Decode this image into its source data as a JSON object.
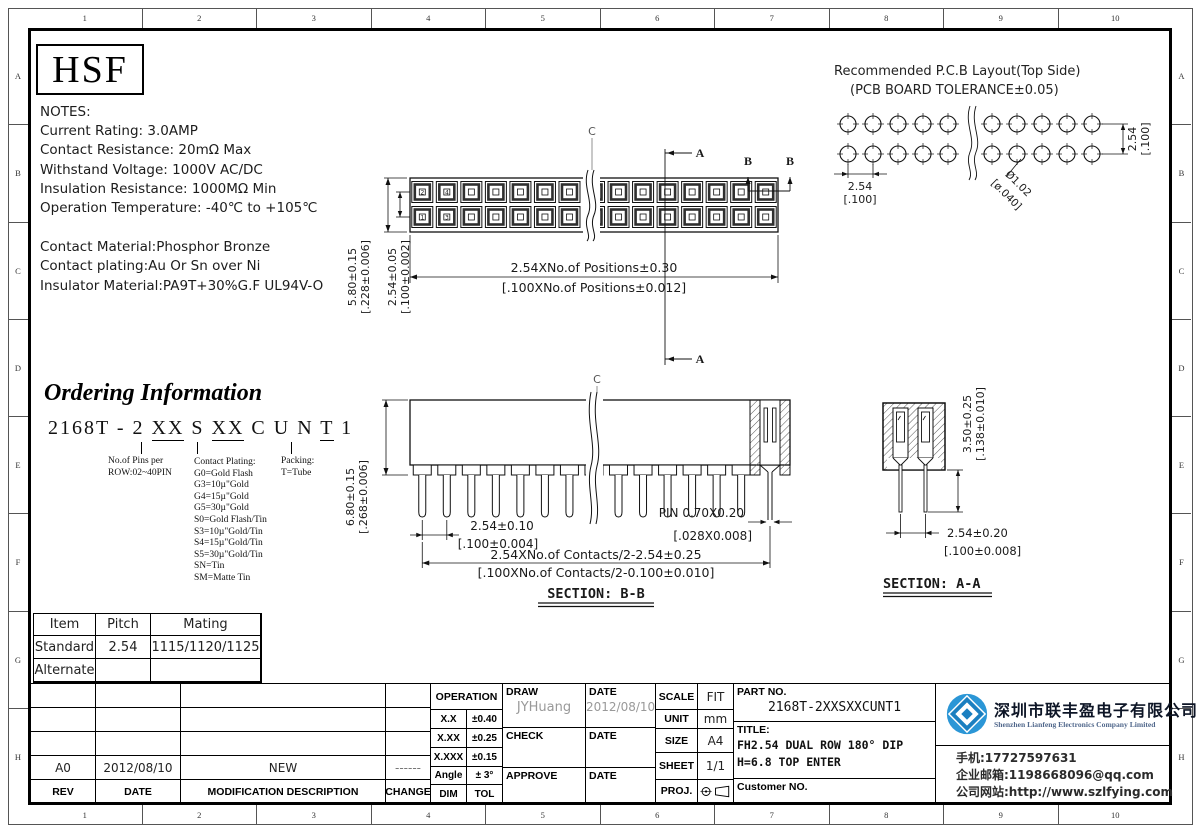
{
  "frame": {
    "columns": [
      "1",
      "2",
      "3",
      "4",
      "5",
      "6",
      "7",
      "8",
      "9",
      "10"
    ],
    "rows": [
      "A",
      "B",
      "C",
      "D",
      "E",
      "F",
      "G",
      "H"
    ]
  },
  "logo": {
    "text": "HSF"
  },
  "notes": {
    "title": "NOTES:",
    "lines": [
      "Current Rating: 3.0AMP",
      "Contact Resistance: 20mΩ Max",
      "Withstand Voltage: 1000V AC/DC",
      "Insulation Resistance: 1000MΩ Min",
      "Operation Temperature: -40℃ to +105℃"
    ],
    "materials": [
      "Contact Material:Phosphor Bronze",
      "Contact plating:Au Or Sn over Ni",
      "Insulator Material:PA9T+30%G.F UL94V-O"
    ]
  },
  "pcb_layout": {
    "title1": "Recommended P.C.B Layout(Top Side)",
    "title2": "(PCB BOARD TOLERANCE±0.05)",
    "dim_h": "2.54",
    "dim_h_bracket": "[.100]",
    "dim_v": "2.54",
    "dim_v_bracket": "[.100]",
    "hole": "Ø1.02",
    "hole_bracket": "[ø.040]"
  },
  "top_view": {
    "centerline_label": "C",
    "section_a_label": "A",
    "section_b_label": "B",
    "pin_numbers": [
      "2",
      "4",
      "1",
      "3"
    ],
    "dim_height": "5.80±0.15",
    "dim_height_bracket": "[.228±0.006]",
    "dim_row_pitch": "2.54±0.05",
    "dim_row_pitch_bracket": "[.100±0.002]",
    "dim_length": "2.54XNo.of Positions±0.30",
    "dim_length_bracket": "[.100XNo.of Positions±0.012]"
  },
  "ordering": {
    "title": "Ordering Information",
    "code_segments": [
      {
        "text": "2168T - 2 ",
        "u": false
      },
      {
        "text": "XX",
        "u": true
      },
      {
        "text": " S ",
        "u": false
      },
      {
        "text": "XX",
        "u": true
      },
      {
        "text": " C U N ",
        "u": false
      },
      {
        "text": "T",
        "u": true
      },
      {
        "text": " 1",
        "u": false
      }
    ],
    "pins_note_1": "No.of Pins per",
    "pins_note_2": "ROW:02~40PIN",
    "plating_title": "Contact Plating:",
    "plating_options": [
      "G0=Gold Flash",
      "G3=10µ\"Gold",
      "G4=15µ\"Gold",
      "G5=30µ\"Gold",
      "S0=Gold Flash/Tin",
      "S3=10µ\"Gold/Tin",
      "S4=15µ\"Gold/Tin",
      "S5=30µ\"Gold/Tin",
      "SN=Tin",
      "SM=Matte Tin"
    ],
    "packing_title": "Packing:",
    "packing_option": "T=Tube"
  },
  "section_bb": {
    "centerline_label": "C",
    "label": "SECTION: B-B",
    "dim_height": "6.80±0.15",
    "dim_height_bracket": "[.268±0.006]",
    "dim_pitch": "2.54±0.10",
    "dim_pitch_bracket": "[.100±0.004]",
    "pin_dim": "PIN 0.70X0.20",
    "pin_dim_bracket": "[.028X0.008]",
    "dim_span": "2.54XNo.of Contacts/2-2.54±0.25",
    "dim_span_bracket": "[.100XNo.of Contacts/2-0.100±0.010]"
  },
  "section_aa": {
    "label": "SECTION: A-A",
    "dim_height": "3.50±0.25",
    "dim_height_bracket": "[.138±0.010]",
    "dim_pitch": "2.54±0.20",
    "dim_pitch_bracket": "[.100±0.008]"
  },
  "mating_table": {
    "headers": [
      "Item",
      "Pitch",
      "Mating"
    ],
    "rows": [
      [
        "Standard",
        "2.54",
        "1115/1120/1125"
      ],
      [
        "Alternate",
        "",
        ""
      ]
    ]
  },
  "revision_table": {
    "headers": [
      "REV",
      "DATE",
      "MODIFICATION DESCRIPTION",
      "CHANGE"
    ],
    "rows": [
      [
        "",
        "",
        "",
        ""
      ],
      [
        "",
        "",
        "",
        ""
      ],
      [
        "",
        "",
        "",
        ""
      ],
      [
        "A0",
        "2012/08/10",
        "NEW",
        "------"
      ]
    ]
  },
  "tolerance_table": {
    "header": "OPERATION",
    "rows": [
      [
        "X.X",
        "±0.40"
      ],
      [
        "X.XX",
        "±0.25"
      ],
      [
        "X.XXX",
        "±0.15"
      ],
      [
        "Angle",
        "± 3°"
      ],
      [
        "DIM",
        "TOL"
      ]
    ]
  },
  "sign_block": {
    "draw_label": "DRAW",
    "draw_name": "JYHuang",
    "draw_date_label": "DATE",
    "draw_date": "2012/08/10",
    "check_label": "CHECK",
    "check_date_label": "DATE",
    "approve_label": "APPROVE",
    "approve_date_label": "DATE"
  },
  "info_block": {
    "scale_label": "SCALE",
    "scale": "FIT",
    "unit_label": "UNIT",
    "unit": "mm",
    "size_label": "SIZE",
    "size": "A4",
    "sheet_label": "SHEET",
    "sheet": "1/1",
    "proj_label": "PROJ."
  },
  "part_block": {
    "part_no_label": "PART NO.",
    "part_no": "2168T-2XXSXXCUNT1",
    "title_label": "TITLE:",
    "title_line1": "FH2.54 DUAL ROW 180° DIP",
    "title_line2": "H=6.8 TOP ENTER",
    "customer_label": "Customer NO."
  },
  "company": {
    "name_cn": "深圳市联丰盈电子有限公司",
    "name_en": "Shenzhen Lianfeng Electronics Company Limited",
    "phone": "手机:17727597631",
    "email": "企业邮箱:1198668096@qq.com",
    "website": "公司网站:http://www.szlfying.com",
    "logo_color": "#2b96d6"
  }
}
